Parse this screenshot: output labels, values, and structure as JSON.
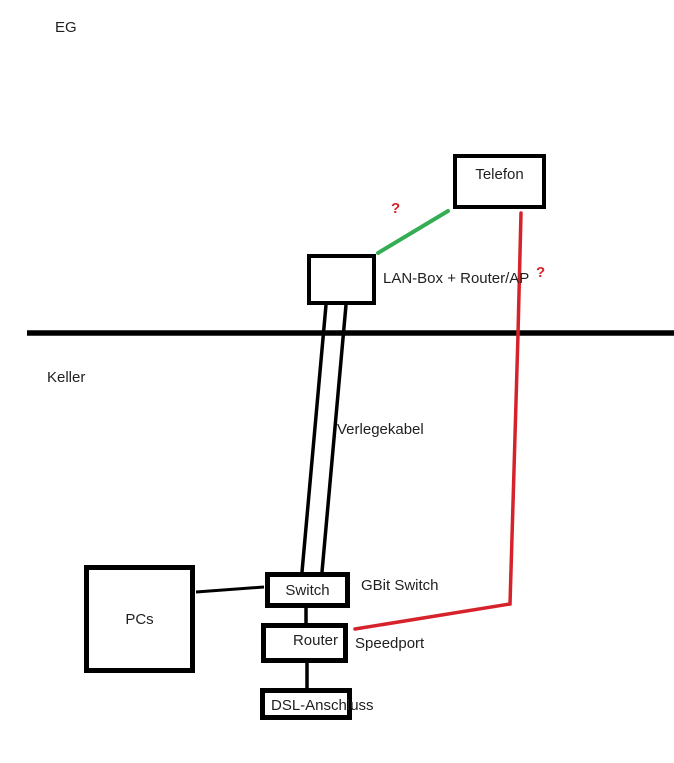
{
  "colors": {
    "background": "#ffffff",
    "ink": "#000000",
    "text": "#1f1f1f",
    "red": "#d6232b",
    "green": "#35ad55"
  },
  "floors": {
    "upper_label": "EG",
    "lower_label": "Keller"
  },
  "nodes": {
    "telefon": {
      "label": "Telefon"
    },
    "lan_box": {
      "caption": "LAN-Box + Router/AP"
    },
    "pcs": {
      "label": "PCs"
    },
    "switch": {
      "label": "Switch",
      "caption": "GBit Switch"
    },
    "router": {
      "label": "Router",
      "caption": "Speedport"
    },
    "dsl": {
      "label": "DSL-Anschluss"
    }
  },
  "edges": {
    "verlegekabel": {
      "label": "Verlegekabel",
      "style": "double-line",
      "color": "#000000"
    },
    "telefon_to_lanbox": {
      "label": "?",
      "color": "#35ad55"
    },
    "telefon_to_speedport": {
      "label": "?",
      "color": "#d6232b"
    },
    "pcs_to_switch": {
      "color": "#000000"
    },
    "switch_to_router": {
      "color": "#000000"
    },
    "router_to_dsl": {
      "color": "#000000"
    }
  }
}
